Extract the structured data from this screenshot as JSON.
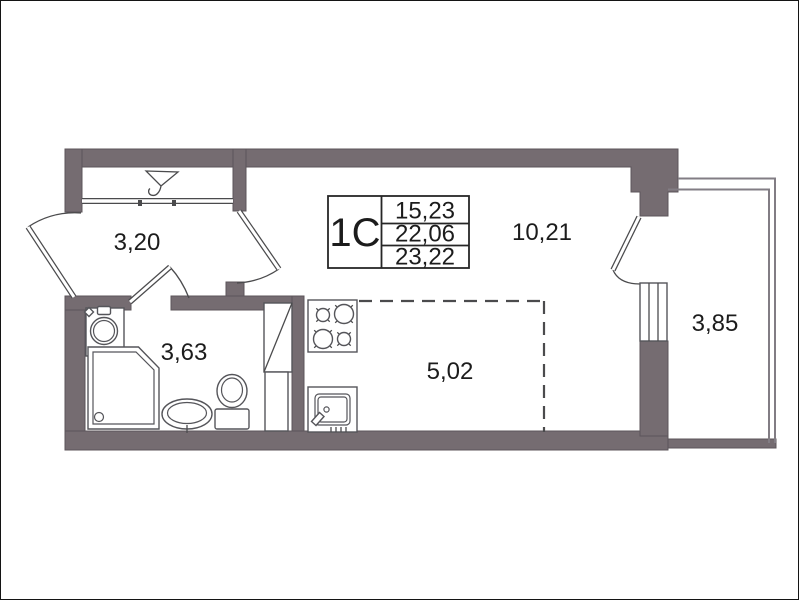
{
  "info_table": {
    "unit_type": "1С",
    "rows": [
      "15,23",
      "22,06",
      "23,22"
    ]
  },
  "rooms": {
    "hallway": "3,20",
    "bathroom": "3,63",
    "kitchen_zone": "5,02",
    "living_room": "10,21",
    "balcony": "3,85"
  },
  "icons": {
    "wardrobe": "hanger-symbol"
  },
  "colors": {
    "wall_fill": "#756C71",
    "wall_edge": "#5C555A",
    "thin_line": "#4B4B4D",
    "fixture_line": "#55555A",
    "glazing_line": "#827D84",
    "dashed_line": "#4B4B4D",
    "table_border": "#262626",
    "text": "#1C1C1C",
    "background": "#FFFFFF"
  }
}
